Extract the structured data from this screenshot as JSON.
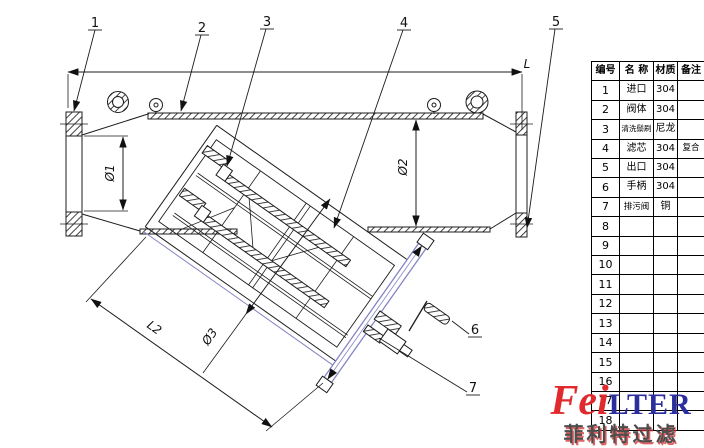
{
  "drawing": {
    "dim_labels": {
      "length": "L",
      "inlet_bore": "Ø1",
      "body_bore": "Ø2",
      "cartridge_od": "Ø3",
      "branch_length": "L2"
    },
    "balloons": {
      "b1": "1",
      "b2": "2",
      "b3": "3",
      "b4": "4",
      "b5": "5",
      "b6": "6",
      "b7": "7"
    }
  },
  "parts_table": {
    "headers": {
      "no": "编号",
      "name": "名 称",
      "material": "材质",
      "note": "备注"
    },
    "rows": [
      {
        "no": "1",
        "name": "进口",
        "material": "304",
        "note": ""
      },
      {
        "no": "2",
        "name": "阀体",
        "material": "304",
        "note": ""
      },
      {
        "no": "3",
        "name": "清洗鬃刷",
        "material": "尼龙",
        "note": ""
      },
      {
        "no": "4",
        "name": "滤芯",
        "material": "304",
        "note": "复合"
      },
      {
        "no": "5",
        "name": "出口",
        "material": "304",
        "note": ""
      },
      {
        "no": "6",
        "name": "手柄",
        "material": "304",
        "note": ""
      },
      {
        "no": "7",
        "name": "排污阀",
        "material": "铜",
        "note": ""
      },
      {
        "no": "8",
        "name": "",
        "material": "",
        "note": ""
      },
      {
        "no": "9",
        "name": "",
        "material": "",
        "note": ""
      },
      {
        "no": "10",
        "name": "",
        "material": "",
        "note": ""
      },
      {
        "no": "11",
        "name": "",
        "material": "",
        "note": ""
      },
      {
        "no": "12",
        "name": "",
        "material": "",
        "note": ""
      },
      {
        "no": "13",
        "name": "",
        "material": "",
        "note": ""
      },
      {
        "no": "14",
        "name": "",
        "material": "",
        "note": ""
      },
      {
        "no": "15",
        "name": "",
        "material": "",
        "note": ""
      },
      {
        "no": "16",
        "name": "",
        "material": "",
        "note": ""
      },
      {
        "no": "17",
        "name": "",
        "material": "",
        "note": ""
      },
      {
        "no": "18",
        "name": "",
        "material": "",
        "note": ""
      }
    ]
  },
  "logo": {
    "brand_red": "Fei",
    "brand_blue": "LTER",
    "brand_cn": "菲利特过滤"
  },
  "colors": {
    "line": "#1c1c1c",
    "accent_blue_line": "#8484c4",
    "logo_red": "#e02a2d",
    "logo_blue": "#2b2f9e",
    "logo_cn_gray": "#4d4d4d"
  }
}
